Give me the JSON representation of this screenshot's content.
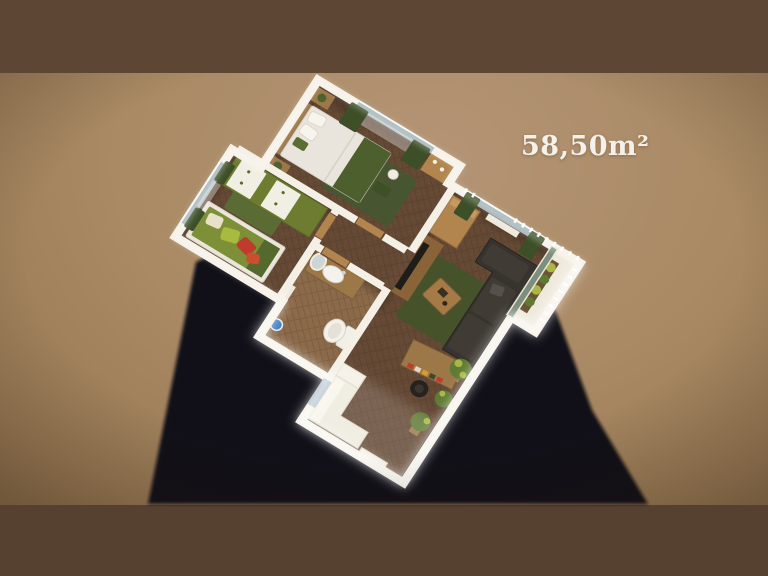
{
  "scene": {
    "area_label": "58,50m²",
    "description": "3D isometric render of a 58.50 sqm apartment floor plan on a tan backdrop with a long cast shadow"
  },
  "palette": {
    "bg_center": "#b49475",
    "bg_mid": "#a98a64",
    "bg_edge": "#8a6c49",
    "band_top": "#5d4734",
    "band_bottom": "#564130",
    "shadow": "#0c0f15",
    "wall": "#f5f0e6",
    "wall_bright": "#ffffff",
    "floor_base": "#5c422f",
    "floor_plank": "#684c37",
    "bath_base": "#7d5e41",
    "bath_plank": "#8b6a4a",
    "curtain": "#3c4f27",
    "wardrobe_green": "#6d7c31",
    "rug_living": "#46522a",
    "rug_kids": "#5a6c33",
    "rug_master": "#475631",
    "kids_bed_green": "#7d9038",
    "pillow_red": "#c03b2c",
    "pillow_lime": "#a8bb3f",
    "sofa_dark": "#37332e",
    "wood": "#9c7849",
    "wood_light": "#b2854e",
    "duvet_white": "#e9e5dc",
    "throw_green": "#4e5f2e",
    "plant_green": "#5e7a33",
    "plant_lime": "#a9b845",
    "water_blue": "#3f7dc4",
    "glass_grey": "#9fb0b4",
    "area_text": "#f5f1ea"
  }
}
